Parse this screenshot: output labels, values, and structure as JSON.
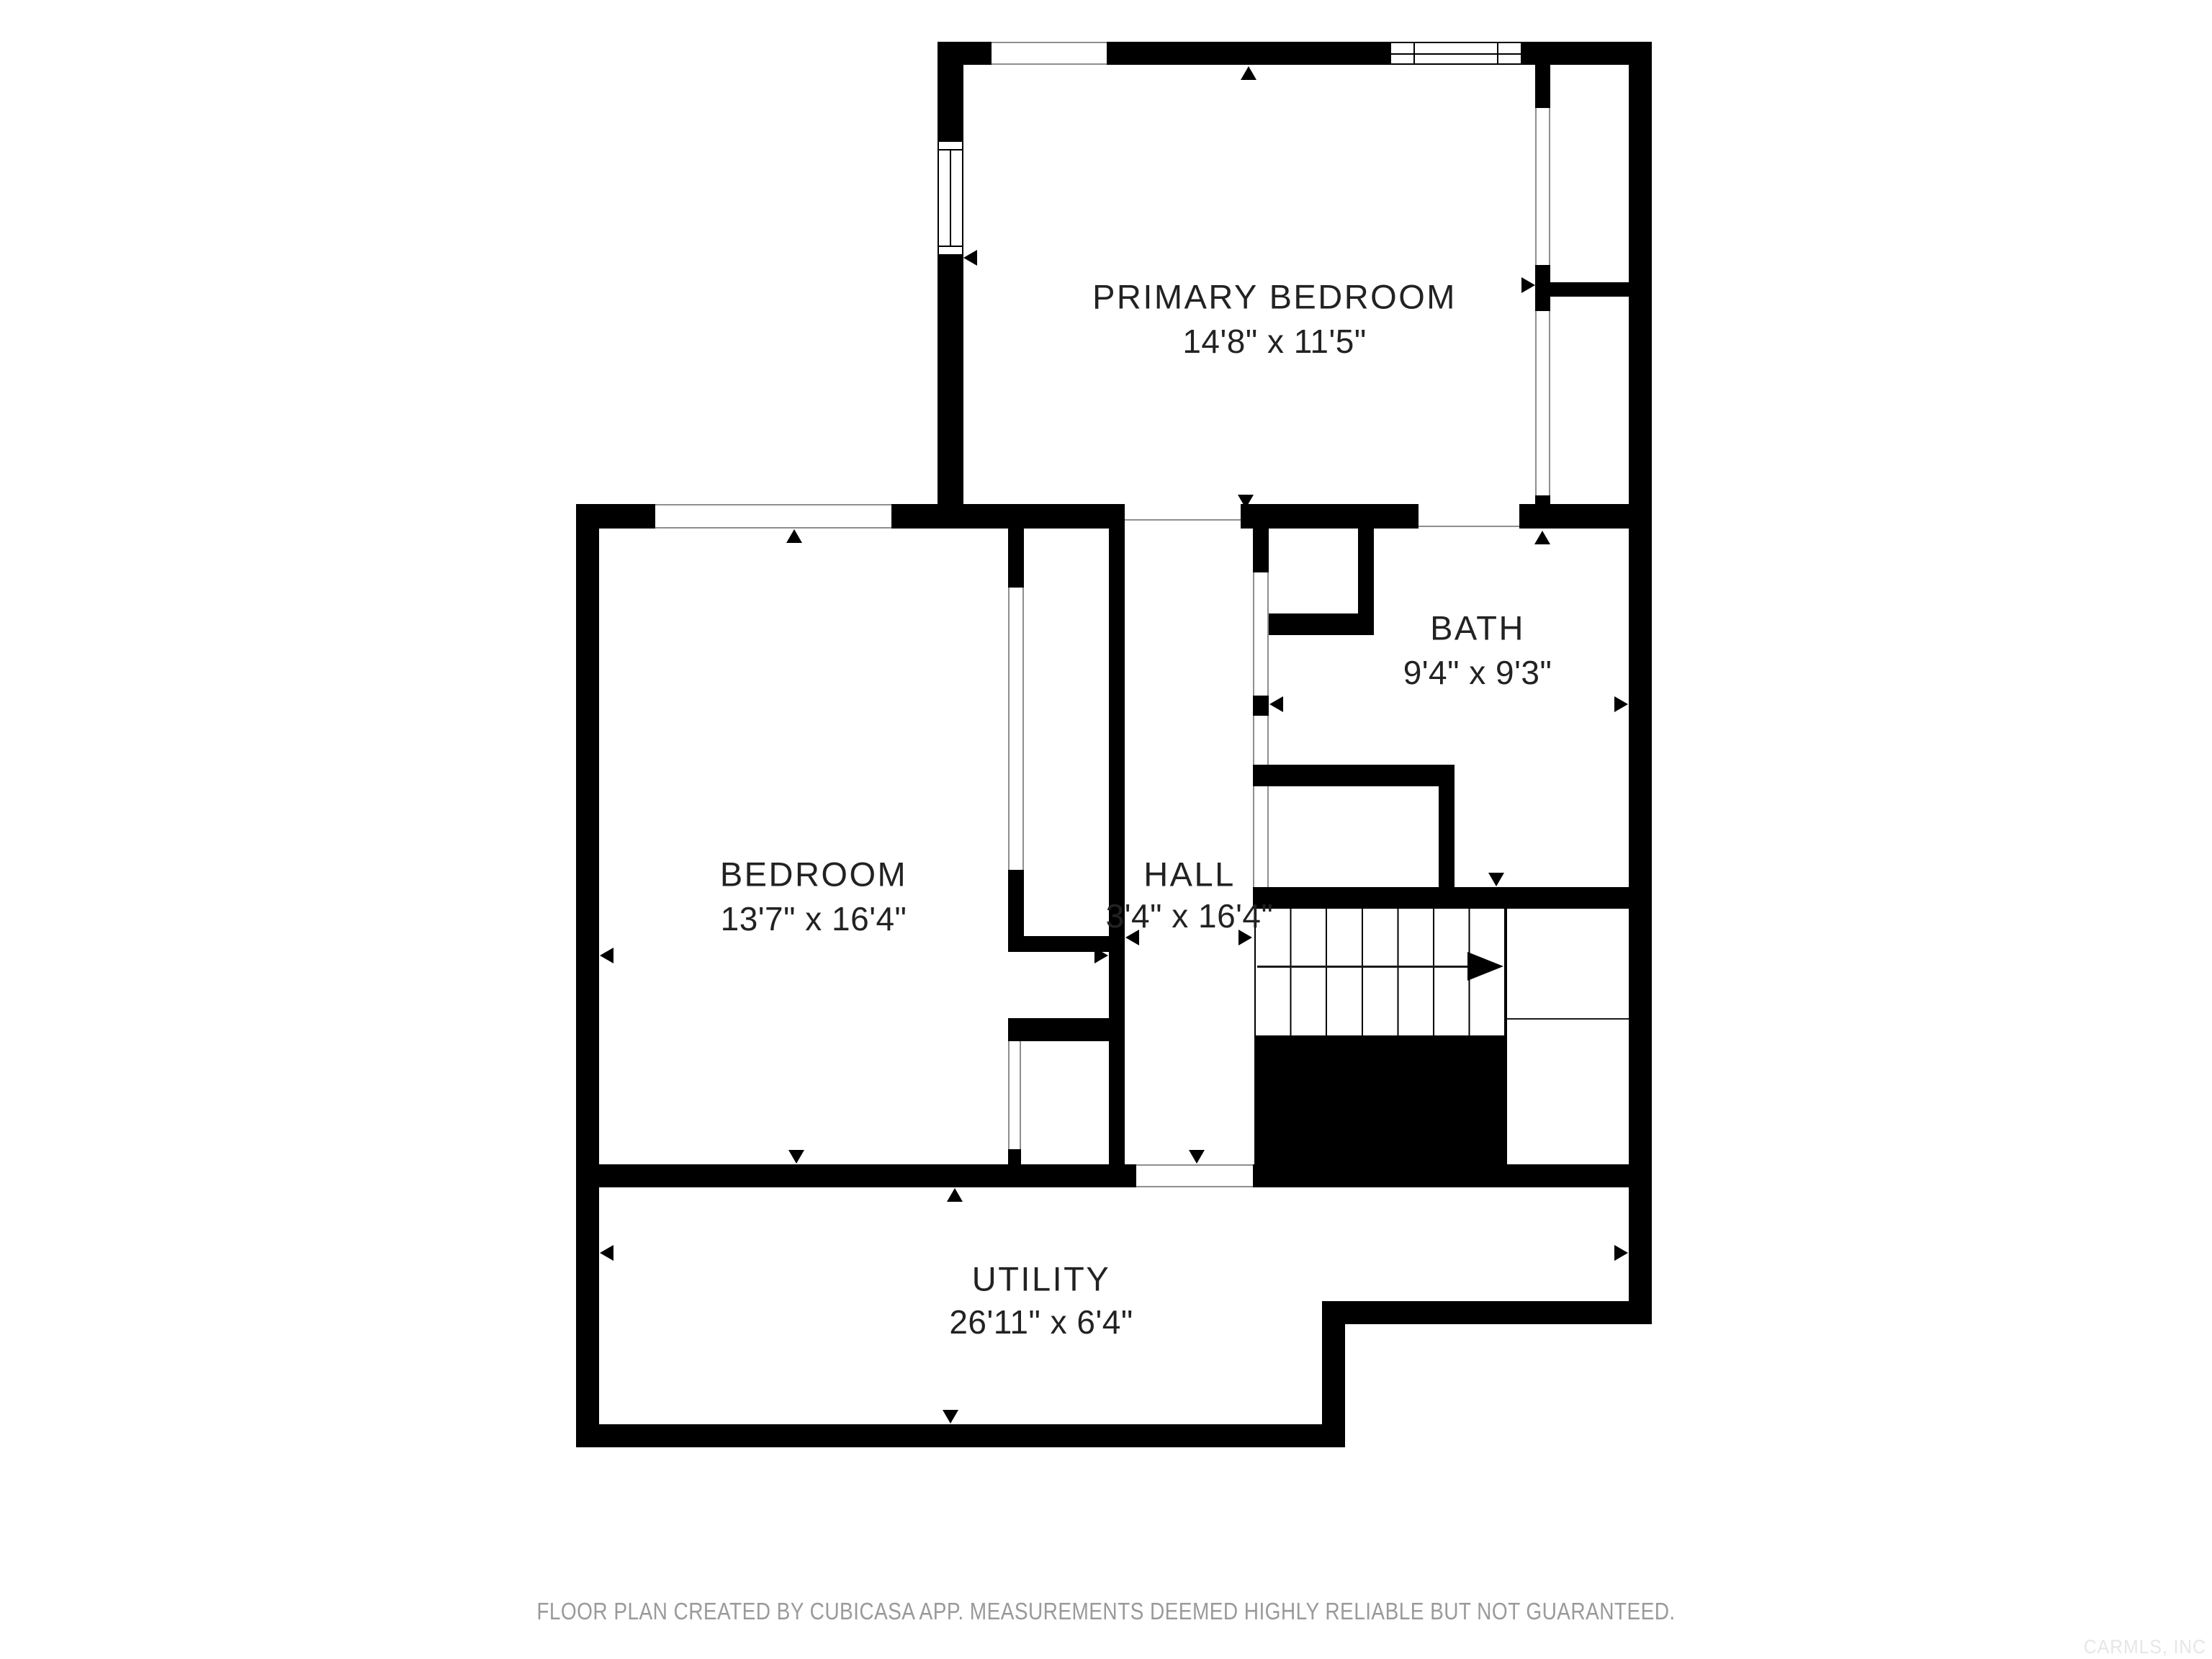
{
  "rooms": {
    "primary_bedroom": {
      "name": "PRIMARY BEDROOM",
      "dimensions": "14'8\" x 11'5\""
    },
    "bedroom": {
      "name": "BEDROOM",
      "dimensions": "13'7\" x 16'4\""
    },
    "bath": {
      "name": "BATH",
      "dimensions": "9'4\" x 9'3\""
    },
    "hall": {
      "name": "HALL",
      "dimensions": "3'4\" x 16'4\""
    },
    "utility": {
      "name": "UTILITY",
      "dimensions": "26'11\" x 6'4\""
    }
  },
  "footer": {
    "disclaimer": "FLOOR PLAN CREATED BY CUBICASA APP. MEASUREMENTS DEEMED HIGHLY RELIABLE BUT NOT GUARANTEED."
  },
  "watermark": {
    "text": "CARMLS, INC"
  },
  "colors": {
    "wall": "#000000",
    "background": "#ffffff",
    "thin_line": "#8f8f8f",
    "footer_text": "#9a9a9a",
    "watermark_text": "#e6e6e6",
    "label_text": "#222222"
  }
}
